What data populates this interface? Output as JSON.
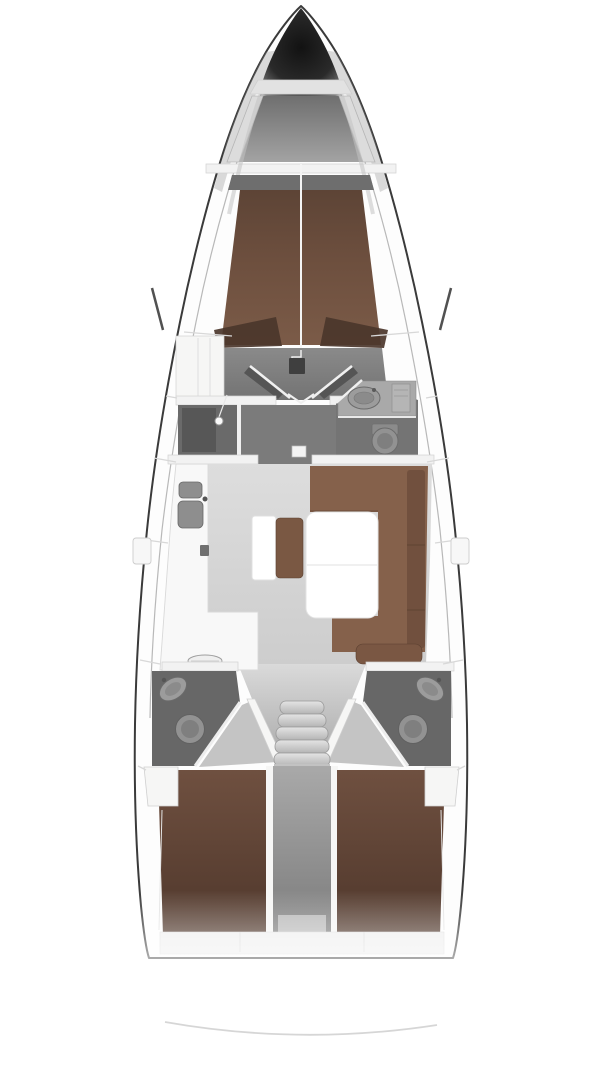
{
  "diagram": {
    "type": "yacht-interior-floor-plan",
    "orientation": "bow-up",
    "regions": [
      "anchor-locker",
      "forward-cabin-v-berth",
      "forward-wardrobe",
      "shower-compartment",
      "forward-head",
      "saloon",
      "galley",
      "chart-table",
      "u-settee-dinette",
      "saloon-table",
      "companionway-steps",
      "aft-head-port",
      "aft-head-starboard",
      "aft-cabin-port-berth",
      "aft-cabin-starboard-berth",
      "engine-compartment",
      "transom"
    ]
  },
  "colors": {
    "background": "#ffffff",
    "hullFill": "#fdfdfd",
    "hullOutline": "#3a3a3a",
    "deckWhite": "#f6f6f5",
    "bulkhead": "#f2f2f2",
    "lockerWall": "#dcdcdc",
    "lockerTrapezoid": "#e2e2e2",
    "shelfBand": "#6e6e6e",
    "berthForwardDark": "#4b362b",
    "cabinFloor": "#818181",
    "showerFloor": "#6a6a6a",
    "showerInner": "#575757",
    "lobbyFloor": "#7b7b7b",
    "headFloor": "#747474",
    "aftHeadFloor": "#676767",
    "counterGray": "#a9a9a9",
    "cabinetGray": "#b5b5b5",
    "sinkGray": "#8e8e8e",
    "fixtureLight": "#9c9c9c",
    "fixtureMid": "#8b8b8b",
    "toiletFill": "#929292",
    "toiletInner": "#7f7f7f",
    "galleyCounter": "#f8f8f8",
    "ovalFixture": "#efefef",
    "tableWhite": "#ffffff",
    "benchBrown": "#7a5843",
    "setteeBrown": "#85614b",
    "setteeBack": "#6f4f3d",
    "cushionBrown": "#7a5743",
    "wedgeFloor": "#c4c4c4",
    "landingGray": "#c2c2c2",
    "transom": "#efefef",
    "sternArc": "#d4d4d4",
    "doorWhite": "#f0f0f0",
    "stepBlock": "#3f3f3f",
    "darkTick": "#333333"
  }
}
